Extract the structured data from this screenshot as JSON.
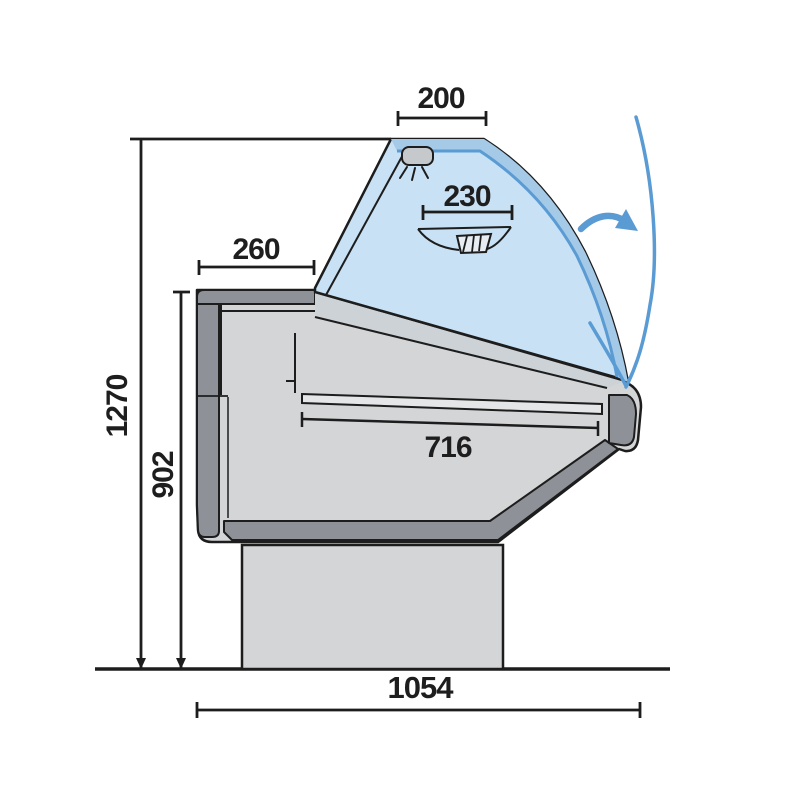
{
  "labels": {
    "canopy_width": "200",
    "inner_shelf_width": "230",
    "rear_top_depth": "260",
    "deck_length": "716",
    "total_height": "1270",
    "worktop_height": "902",
    "overall_depth": "1054"
  },
  "icons": {
    "lamp": "ceiling-lamp-with-light-rays",
    "fan_shelf": "hatched-shelf-tray",
    "swing_arrow": "curved-open-direction-arrow",
    "open_glass": "glass-open-position-arc"
  },
  "colors": {
    "outline": "#1d1d1d",
    "body_light_gray": "#d3d5d7",
    "panel_dark_gray": "#8e9298",
    "wedge_gray": "#cdd2d6",
    "deck_fill": "#e4e6e7",
    "lamp_gray": "#c6c9cc",
    "fan_box_fill": "#e7edf2",
    "glass_blue": "#c8e1f4",
    "glass_edge_blue": "#a5cae8",
    "accent_blue": "#5b9bd4",
    "label_color": "#1e1e1e",
    "background": "#ffffff"
  }
}
